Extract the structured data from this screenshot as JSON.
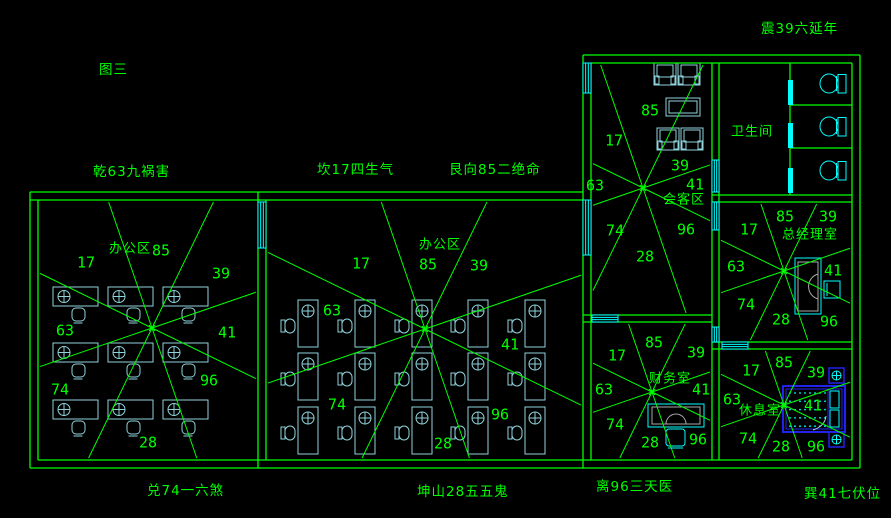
{
  "colors": {
    "background": "#000000",
    "wall_green": "#00ff00",
    "text_green": "#00ff00",
    "furniture_cyan": "#8fd4dc",
    "bright_cyan": "#00ffff",
    "bed_blue": "#2222ee",
    "desk_inner_gray": "#a8a8a8"
  },
  "edge_labels": [
    {
      "text": "图三",
      "x": 99,
      "y": 58
    },
    {
      "text": "乾63九祸害",
      "x": 93,
      "y": 160
    },
    {
      "text": "坎17四生气",
      "x": 317,
      "y": 158
    },
    {
      "text": "艮向85二绝命",
      "x": 449,
      "y": 158
    },
    {
      "text": "震39六延年",
      "x": 761,
      "y": 17
    },
    {
      "text": "兑74一六煞",
      "x": 147,
      "y": 479
    },
    {
      "text": "坤山28五五鬼",
      "x": 417,
      "y": 480
    },
    {
      "text": "离96三天医",
      "x": 596,
      "y": 475
    },
    {
      "text": "巽41七伏位",
      "x": 804,
      "y": 482
    }
  ],
  "ray_angles": [
    26,
    71,
    116,
    161,
    206,
    251,
    296,
    341
  ],
  "rooms": [
    {
      "id": "office-left",
      "label": "办公区",
      "label_x": 130,
      "label_y": 249,
      "rect": [
        40,
        202,
        256,
        458
      ],
      "center": [
        152,
        328
      ],
      "numbers": [
        {
          "t": "17",
          "x": 86,
          "y": 263
        },
        {
          "t": "85",
          "x": 161,
          "y": 251
        },
        {
          "t": "39",
          "x": 221,
          "y": 274
        },
        {
          "t": "63",
          "x": 65,
          "y": 331
        },
        {
          "t": "41",
          "x": 227,
          "y": 333
        },
        {
          "t": "74",
          "x": 60,
          "y": 390
        },
        {
          "t": "96",
          "x": 209,
          "y": 381
        },
        {
          "t": "28",
          "x": 148,
          "y": 443
        }
      ]
    },
    {
      "id": "office-mid",
      "label": "办公区",
      "label_x": 440,
      "label_y": 245,
      "rect": [
        268,
        202,
        581,
        458
      ],
      "center": [
        425,
        329
      ],
      "numbers": [
        {
          "t": "17",
          "x": 361,
          "y": 264
        },
        {
          "t": "85",
          "x": 428,
          "y": 265
        },
        {
          "t": "39",
          "x": 479,
          "y": 266
        },
        {
          "t": "63",
          "x": 332,
          "y": 311
        },
        {
          "t": "41",
          "x": 510,
          "y": 345
        },
        {
          "t": "74",
          "x": 337,
          "y": 405
        },
        {
          "t": "96",
          "x": 500,
          "y": 415
        },
        {
          "t": "28",
          "x": 443,
          "y": 444
        }
      ]
    },
    {
      "id": "meeting-room",
      "label": "会客区",
      "label_x": 684,
      "label_y": 200,
      "rect": [
        593,
        65,
        710,
        313
      ],
      "center": [
        643,
        188
      ],
      "numbers": [
        {
          "t": "85",
          "x": 650,
          "y": 111
        },
        {
          "t": "17",
          "x": 614,
          "y": 141
        },
        {
          "t": "39",
          "x": 680,
          "y": 166
        },
        {
          "t": "63",
          "x": 595,
          "y": 186
        },
        {
          "t": "41",
          "x": 695,
          "y": 185
        },
        {
          "t": "74",
          "x": 615,
          "y": 231
        },
        {
          "t": "96",
          "x": 686,
          "y": 230
        },
        {
          "t": "28",
          "x": 645,
          "y": 257
        }
      ]
    },
    {
      "id": "bathroom",
      "label": "卫生间",
      "label_x": 752,
      "label_y": 132,
      "rect": null,
      "center": null,
      "numbers": []
    },
    {
      "id": "manager-room",
      "label": "总经理室",
      "label_x": 810,
      "label_y": 235,
      "rect": [
        721,
        204,
        850,
        340
      ],
      "center": [
        784,
        271
      ],
      "numbers": [
        {
          "t": "85",
          "x": 785,
          "y": 217
        },
        {
          "t": "39",
          "x": 828,
          "y": 217
        },
        {
          "t": "17",
          "x": 749,
          "y": 230
        },
        {
          "t": "63",
          "x": 736,
          "y": 267
        },
        {
          "t": "41",
          "x": 833,
          "y": 271
        },
        {
          "t": "74",
          "x": 746,
          "y": 305
        },
        {
          "t": "28",
          "x": 781,
          "y": 320
        },
        {
          "t": "96",
          "x": 829,
          "y": 322
        }
      ]
    },
    {
      "id": "finance-room",
      "label": "财务室",
      "label_x": 670,
      "label_y": 379,
      "rect": [
        593,
        324,
        710,
        458
      ],
      "center": [
        652,
        392
      ],
      "numbers": [
        {
          "t": "85",
          "x": 654,
          "y": 343
        },
        {
          "t": "17",
          "x": 617,
          "y": 356
        },
        {
          "t": "39",
          "x": 696,
          "y": 353
        },
        {
          "t": "63",
          "x": 604,
          "y": 390
        },
        {
          "t": "41",
          "x": 701,
          "y": 390
        },
        {
          "t": "74",
          "x": 615,
          "y": 425
        },
        {
          "t": "28",
          "x": 650,
          "y": 443
        },
        {
          "t": "96",
          "x": 698,
          "y": 440
        }
      ]
    },
    {
      "id": "rest-room",
      "label": "休息室",
      "label_x": 760,
      "label_y": 411,
      "rect": [
        721,
        351,
        850,
        458
      ],
      "center": [
        784,
        405
      ],
      "numbers": [
        {
          "t": "85",
          "x": 784,
          "y": 363
        },
        {
          "t": "17",
          "x": 751,
          "y": 371
        },
        {
          "t": "39",
          "x": 816,
          "y": 373
        },
        {
          "t": "63",
          "x": 732,
          "y": 400
        },
        {
          "t": "41",
          "x": 813,
          "y": 406
        },
        {
          "t": "74",
          "x": 748,
          "y": 439
        },
        {
          "t": "28",
          "x": 781,
          "y": 447
        },
        {
          "t": "96",
          "x": 816,
          "y": 447
        }
      ]
    }
  ],
  "walls": [
    [
      30,
      192,
      583,
      192
    ],
    [
      30,
      200,
      583,
      200
    ],
    [
      30,
      192,
      30,
      468
    ],
    [
      38,
      200,
      38,
      460
    ],
    [
      30,
      468,
      860,
      468
    ],
    [
      38,
      460,
      852,
      460
    ],
    [
      860,
      55,
      860,
      468
    ],
    [
      852,
      63,
      852,
      460
    ],
    [
      583,
      55,
      860,
      55
    ],
    [
      591,
      63,
      852,
      63
    ],
    [
      583,
      55,
      583,
      468
    ],
    [
      591,
      63,
      591,
      460
    ],
    [
      258,
      192,
      258,
      468
    ],
    [
      266,
      200,
      266,
      460
    ],
    [
      712,
      63,
      712,
      460
    ],
    [
      719,
      63,
      719,
      460
    ],
    [
      583,
      315,
      712,
      315
    ],
    [
      583,
      322,
      712,
      322
    ],
    [
      712,
      195,
      852,
      195
    ],
    [
      712,
      202,
      852,
      202
    ],
    [
      712,
      342,
      852,
      342
    ],
    [
      712,
      349,
      852,
      349
    ],
    [
      790,
      63,
      790,
      195
    ],
    [
      790,
      105,
      852,
      105
    ],
    [
      790,
      148,
      852,
      148
    ]
  ],
  "windows": [
    {
      "x": 258,
      "y": 202,
      "w": 8,
      "h": 46,
      "o": "v"
    },
    {
      "x": 583,
      "y": 63,
      "w": 8,
      "h": 30,
      "o": "v"
    },
    {
      "x": 583,
      "y": 200,
      "w": 8,
      "h": 55,
      "o": "v"
    },
    {
      "x": 712,
      "y": 160,
      "w": 7,
      "h": 32,
      "o": "v"
    },
    {
      "x": 712,
      "y": 202,
      "w": 7,
      "h": 28,
      "o": "v"
    },
    {
      "x": 712,
      "y": 327,
      "w": 7,
      "h": 15,
      "o": "v"
    },
    {
      "x": 592,
      "y": 315,
      "w": 26,
      "h": 7,
      "o": "h"
    },
    {
      "x": 722,
      "y": 342,
      "w": 26,
      "h": 7,
      "o": "h"
    },
    {
      "x": 788,
      "y": 80,
      "w": 5,
      "h": 25,
      "o": "bar"
    },
    {
      "x": 788,
      "y": 123,
      "w": 5,
      "h": 25,
      "o": "bar"
    },
    {
      "x": 788,
      "y": 168,
      "w": 5,
      "h": 25,
      "o": "bar"
    }
  ],
  "furniture": [
    {
      "type": "desk-h",
      "x": 53,
      "y": 287
    },
    {
      "type": "desk-h",
      "x": 108,
      "y": 287
    },
    {
      "type": "desk-h",
      "x": 163,
      "y": 287
    },
    {
      "type": "desk-h",
      "x": 53,
      "y": 343
    },
    {
      "type": "desk-h",
      "x": 108,
      "y": 343
    },
    {
      "type": "desk-h",
      "x": 163,
      "y": 343
    },
    {
      "type": "desk-h",
      "x": 53,
      "y": 400
    },
    {
      "type": "desk-h",
      "x": 108,
      "y": 400
    },
    {
      "type": "desk-h",
      "x": 163,
      "y": 400
    },
    {
      "type": "chair-front",
      "x": 72,
      "y": 308
    },
    {
      "type": "chair-front",
      "x": 127,
      "y": 308
    },
    {
      "type": "chair-front",
      "x": 182,
      "y": 308
    },
    {
      "type": "chair-front",
      "x": 72,
      "y": 364
    },
    {
      "type": "chair-front",
      "x": 127,
      "y": 364
    },
    {
      "type": "chair-front",
      "x": 182,
      "y": 364
    },
    {
      "type": "chair-front",
      "x": 72,
      "y": 421
    },
    {
      "type": "chair-front",
      "x": 127,
      "y": 421
    },
    {
      "type": "chair-front",
      "x": 182,
      "y": 421
    },
    {
      "type": "desk-v",
      "x": 298,
      "y": 300
    },
    {
      "type": "desk-v",
      "x": 355,
      "y": 300
    },
    {
      "type": "desk-v",
      "x": 412,
      "y": 300
    },
    {
      "type": "desk-v",
      "x": 468,
      "y": 300
    },
    {
      "type": "desk-v",
      "x": 525,
      "y": 300
    },
    {
      "type": "desk-v",
      "x": 298,
      "y": 353
    },
    {
      "type": "desk-v",
      "x": 355,
      "y": 353
    },
    {
      "type": "desk-v",
      "x": 412,
      "y": 353
    },
    {
      "type": "desk-v",
      "x": 468,
      "y": 353
    },
    {
      "type": "desk-v",
      "x": 525,
      "y": 353
    },
    {
      "type": "desk-v",
      "x": 298,
      "y": 407
    },
    {
      "type": "desk-v",
      "x": 355,
      "y": 407
    },
    {
      "type": "desk-v",
      "x": 412,
      "y": 407
    },
    {
      "type": "desk-v",
      "x": 468,
      "y": 407
    },
    {
      "type": "desk-v",
      "x": 525,
      "y": 407
    },
    {
      "type": "chair-side",
      "x": 281,
      "y": 319
    },
    {
      "type": "chair-side",
      "x": 338,
      "y": 319
    },
    {
      "type": "chair-side",
      "x": 395,
      "y": 319
    },
    {
      "type": "chair-side",
      "x": 451,
      "y": 319
    },
    {
      "type": "chair-side",
      "x": 508,
      "y": 319
    },
    {
      "type": "chair-side",
      "x": 281,
      "y": 372
    },
    {
      "type": "chair-side",
      "x": 338,
      "y": 372
    },
    {
      "type": "chair-side",
      "x": 395,
      "y": 372
    },
    {
      "type": "chair-side",
      "x": 451,
      "y": 372
    },
    {
      "type": "chair-side",
      "x": 508,
      "y": 372
    },
    {
      "type": "chair-side",
      "x": 281,
      "y": 426
    },
    {
      "type": "chair-side",
      "x": 338,
      "y": 426
    },
    {
      "type": "chair-side",
      "x": 395,
      "y": 426
    },
    {
      "type": "chair-side",
      "x": 451,
      "y": 426
    },
    {
      "type": "chair-side",
      "x": 508,
      "y": 426
    },
    {
      "type": "armchair",
      "x": 654,
      "y": 63
    },
    {
      "type": "armchair",
      "x": 678,
      "y": 63
    },
    {
      "type": "table",
      "x": 666,
      "y": 98
    },
    {
      "type": "armchair",
      "x": 657,
      "y": 128
    },
    {
      "type": "armchair",
      "x": 681,
      "y": 128
    },
    {
      "type": "toilet",
      "x": 818,
      "y": 71
    },
    {
      "type": "toilet",
      "x": 818,
      "y": 114
    },
    {
      "type": "toilet",
      "x": 818,
      "y": 158
    },
    {
      "type": "exec-desk",
      "x": 795,
      "y": 258
    },
    {
      "type": "exec-chair",
      "x": 824,
      "y": 281
    },
    {
      "type": "fin-desk",
      "x": 648,
      "y": 404
    },
    {
      "type": "fin-chair",
      "x": 666,
      "y": 429
    },
    {
      "type": "bed",
      "x": 783,
      "y": 386
    },
    {
      "type": "nightstand",
      "x": 829,
      "y": 368
    },
    {
      "type": "nightstand",
      "x": 829,
      "y": 432
    }
  ]
}
